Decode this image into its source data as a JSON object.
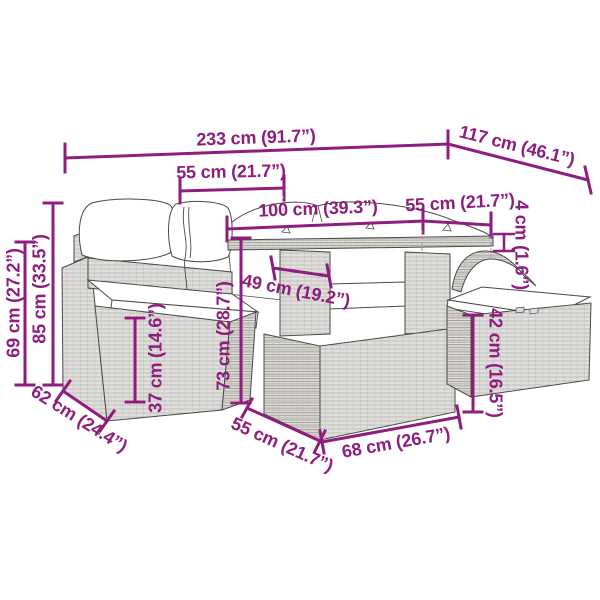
{
  "diagram": {
    "kind": "furniture-dimension-diagram",
    "colors": {
      "dimension_color": "#8E1D7E",
      "outline_color": "#4a4a4a",
      "cushion_color": "#ffffff",
      "weave_color": "#9a9a9a"
    }
  },
  "dims": {
    "overall_width": "233 cm (91.7”)",
    "overall_depth": "117 cm (46.1”)",
    "seat_width": "55 cm (21.7”)",
    "table_top_width": "100 cm (39.3”)",
    "table_top_depth": "55 cm (21.7”)",
    "table_top_thickness": "4 cm (1.6”)",
    "table_inner_width": "49 cm (19.2”)",
    "back_height": "69 cm (27.2”)",
    "total_height": "85 cm (33.5”)",
    "seat_height": "37 cm (14.6”)",
    "table_height": "73 cm (28.7”)",
    "ottoman_height": "42 cm (16.5”)",
    "sofa_depth": "62 cm (24.4”)",
    "base_depth": "55 cm (21.7”)",
    "base_width": "68 cm (26.7”)"
  }
}
